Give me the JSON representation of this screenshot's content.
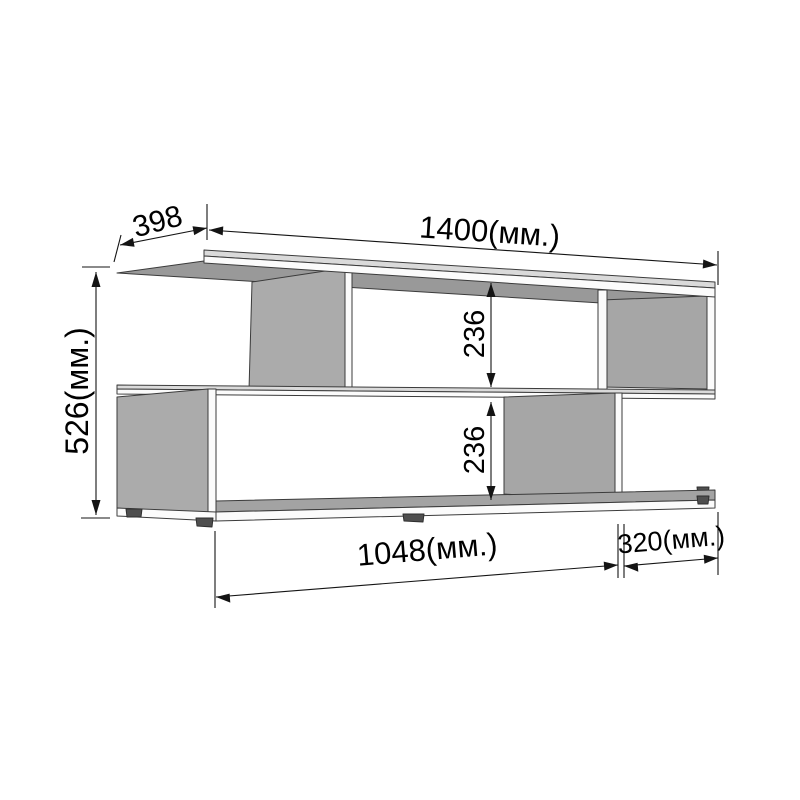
{
  "drawing": {
    "kind": "furniture-dimension-drawing",
    "unit_note": "(мм.)",
    "dims": {
      "depth": "398",
      "width": "1400(мм.)",
      "height": "526(мм.)",
      "upper_clearance": "236",
      "lower_clearance": "236",
      "bottom_span_left": "1048(мм.)",
      "bottom_span_right": "320(мм.)"
    },
    "colors": {
      "background": "#ffffff",
      "outline": "#3b3b3b",
      "dimension_ink": "#141414",
      "face_front_white": "#fbfbfb",
      "face_top_light": "#dadada",
      "face_side_gray": "#ababab",
      "face_inner_gray": "#a6a6a6",
      "face_underside_gray": "#999999",
      "face_bottom_top_gray": "#a3a3a3",
      "foot_dark": "#4f4f4f"
    }
  }
}
